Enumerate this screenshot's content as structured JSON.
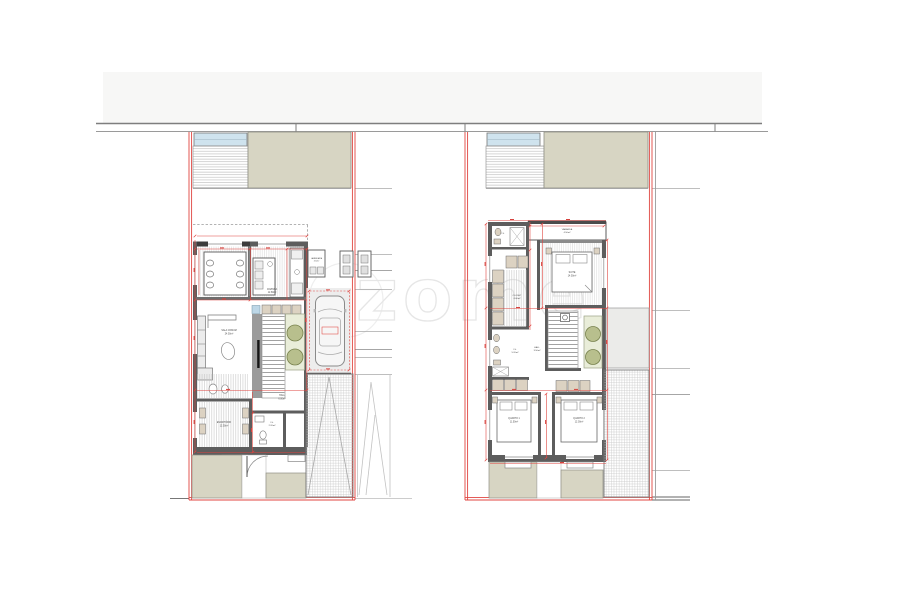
{
  "watermark": {
    "text": "zome"
  },
  "colors": {
    "boundary_red": "#e04540",
    "wall_gray": "#5d5d5d",
    "patio_beige": "#d7d5c3",
    "window_blue": "#cfe3ee",
    "planter_green": "#e9edd9",
    "tree_olive": "#b8bf8d",
    "road_gray": "#f7f7f6",
    "watermark_gray": "#e4e4e4"
  },
  "plans": {
    "left": {
      "rooms": [
        {
          "label": "COZINHA",
          "area": "12.80m²"
        },
        {
          "label": "SALA COMUM",
          "area": "24.50m²"
        },
        {
          "label": "LAVANDARIA",
          "area": "3.50m²"
        },
        {
          "label": "HALL",
          "area": "6.00m²"
        },
        {
          "label": "ESCRITÓRIO",
          "area": "12.50m²"
        },
        {
          "label": "I.S.",
          "area": "2.20m²"
        }
      ]
    },
    "right": {
      "rooms": [
        {
          "label": "VARANDA",
          "area": "4.50m²"
        },
        {
          "label": "SUITE",
          "area": "14.50m²"
        },
        {
          "label": "CLOSET",
          "area": "6.00m²"
        },
        {
          "label": "I.S.",
          "area": "5.20m²"
        },
        {
          "label": "HALL",
          "area": "3.50m²"
        },
        {
          "label": "QUARTO 1",
          "area": "11.50m²"
        },
        {
          "label": "QUARTO 2",
          "area": "12.00m²"
        },
        {
          "label": "I.S.",
          "area": "4.00m²"
        }
      ]
    }
  }
}
